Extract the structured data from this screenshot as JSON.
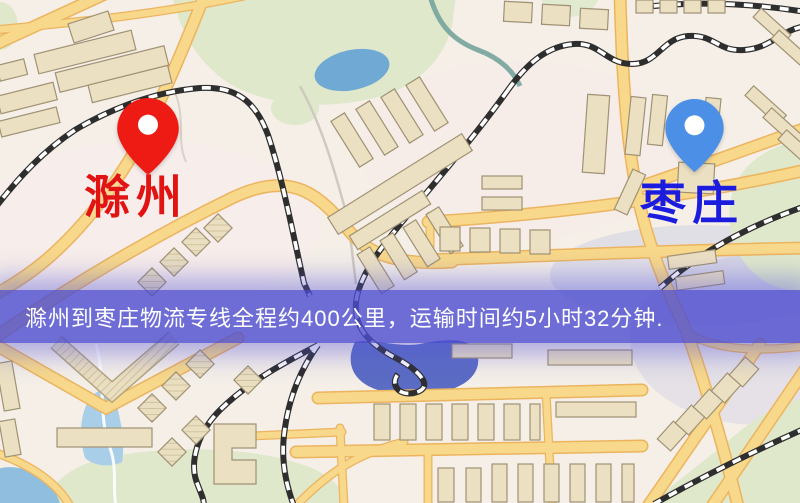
{
  "map": {
    "origin": {
      "label": "滁州",
      "pin": "red-map-pin",
      "label_color": "#e11313"
    },
    "destination": {
      "label": "枣庄",
      "pin": "blue-map-pin",
      "label_color": "#1c1cdf"
    },
    "banner": {
      "text": "滁州到枣庄物流专线全程约400公里，运输时间约5小时32分钟.",
      "background": "#4c4cd0",
      "text_color": "#ffffff"
    },
    "colors": {
      "pin_origin": "#ee1b15",
      "pin_destination": "#4b90e6",
      "land": "#f5efe8",
      "road": "#f8d88a",
      "road_casing": "#ecb45f",
      "park": "#dfe8cb",
      "water": "#6fa9d4",
      "building": "#ece0c2",
      "railway": "#2e2e2e",
      "banner_overlay": "#4c4cd0"
    }
  }
}
